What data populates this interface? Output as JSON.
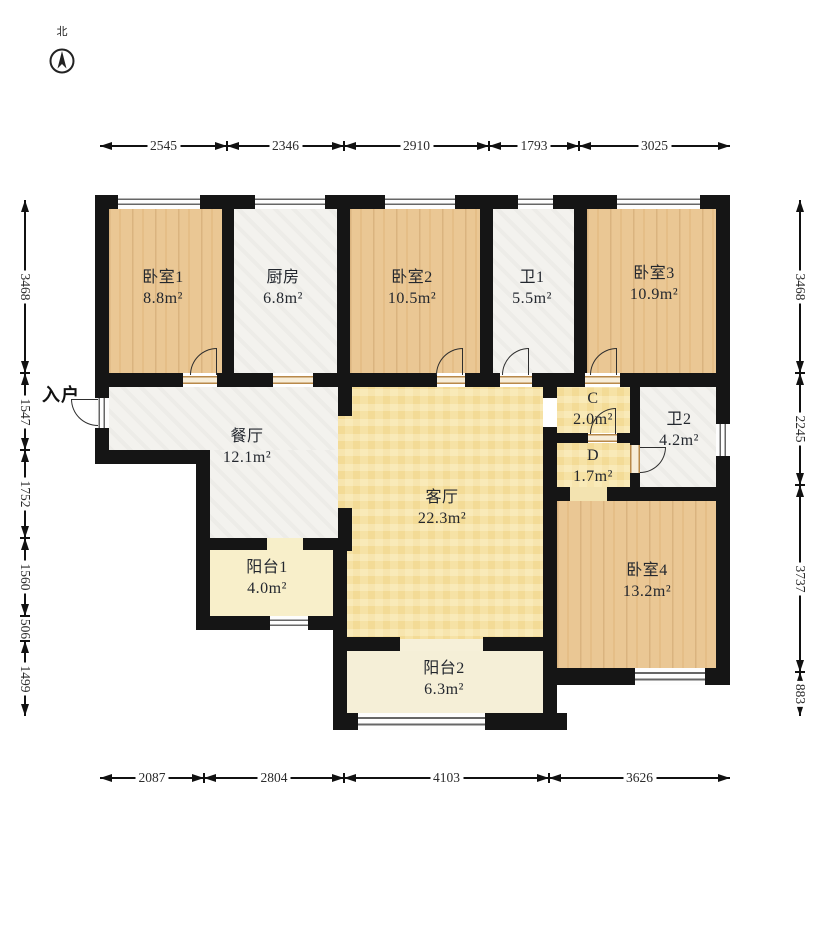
{
  "compass": {
    "label": "北"
  },
  "entry": {
    "label": "入户"
  },
  "rooms": [
    {
      "id": "bedroom1",
      "name": "卧室1",
      "area": "8.8m²"
    },
    {
      "id": "kitchen",
      "name": "厨房",
      "area": "6.8m²"
    },
    {
      "id": "bedroom2",
      "name": "卧室2",
      "area": "10.5m²"
    },
    {
      "id": "bath1",
      "name": "卫1",
      "area": "5.5m²"
    },
    {
      "id": "bedroom3",
      "name": "卧室3",
      "area": "10.9m²"
    },
    {
      "id": "dining",
      "name": "餐厅",
      "area": "12.1m²"
    },
    {
      "id": "living",
      "name": "客厅",
      "area": "22.3m²"
    },
    {
      "id": "closet-c",
      "name": "C",
      "area": "2.0m²"
    },
    {
      "id": "hall-d",
      "name": "D",
      "area": "1.7m²"
    },
    {
      "id": "bath2",
      "name": "卫2",
      "area": "4.2m²"
    },
    {
      "id": "bedroom4",
      "name": "卧室4",
      "area": "13.2m²"
    },
    {
      "id": "balcony1",
      "name": "阳台1",
      "area": "4.0m²"
    },
    {
      "id": "balcony2",
      "name": "阳台2",
      "area": "6.3m²"
    }
  ],
  "dimensions": {
    "top": [
      "2545",
      "2346",
      "2910",
      "1793",
      "3025"
    ],
    "bottom": [
      "2087",
      "2804",
      "4103",
      "3626"
    ],
    "left": [
      "3468",
      "1547",
      "1752",
      "1560",
      "506",
      "1499"
    ],
    "right": [
      "3468",
      "2245",
      "3737",
      "883"
    ]
  }
}
